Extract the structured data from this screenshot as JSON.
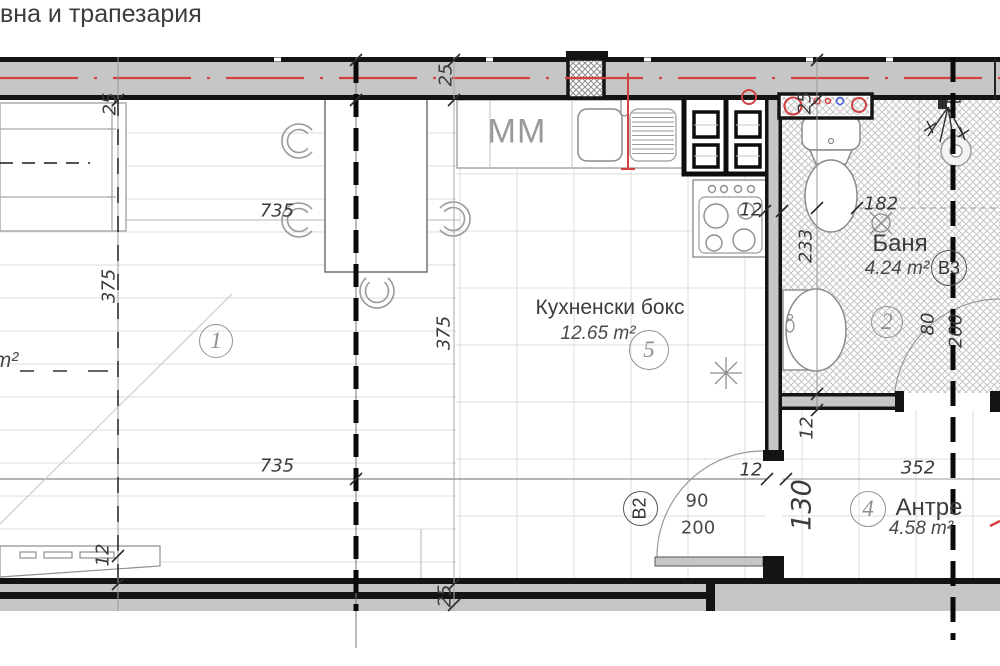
{
  "rooms": {
    "living": {
      "label": "вна и трапезария",
      "area_unit": "m²",
      "number": "1"
    },
    "kitchen": {
      "label": "Кухненски бокс",
      "area": "12.65 m²",
      "number": "5"
    },
    "bathroom": {
      "label": "Баня",
      "area": "4.24 m²",
      "number": "2"
    },
    "hallway": {
      "label": "Антре",
      "area": "4.58 m²",
      "number": "4"
    }
  },
  "markers": {
    "door_b2": "В2",
    "door_b3": "В3",
    "kitchen_unit": "MM"
  },
  "dimension_labels": [
    {
      "text": "25",
      "x": 110,
      "y": 104,
      "rot": -90
    },
    {
      "text": "25",
      "x": 446,
      "y": 75,
      "rot": -90
    },
    {
      "text": "25",
      "x": 805,
      "y": 103,
      "rot": -90
    },
    {
      "text": "25",
      "x": 445,
      "y": 596,
      "rot": -90
    },
    {
      "text": "735",
      "x": 277,
      "y": 211
    },
    {
      "text": "735",
      "x": 277,
      "y": 466
    },
    {
      "text": "375",
      "x": 109,
      "y": 286,
      "rot": -90
    },
    {
      "text": "375",
      "x": 444,
      "y": 333,
      "rot": -90
    },
    {
      "text": "12",
      "x": 103,
      "y": 555,
      "rot": -90
    },
    {
      "text": "12",
      "x": 751,
      "y": 210
    },
    {
      "text": "12",
      "x": 807,
      "y": 428,
      "rot": -90
    },
    {
      "text": "12",
      "x": 751,
      "y": 470
    },
    {
      "text": "233",
      "x": 806,
      "y": 246,
      "rot": -90
    },
    {
      "text": "182",
      "x": 881,
      "y": 204
    },
    {
      "text": "80",
      "x": 928,
      "y": 324,
      "rot": -90
    },
    {
      "text": "200",
      "x": 956,
      "y": 331,
      "rot": -90
    },
    {
      "text": "90",
      "x": 697,
      "y": 501,
      "upright": true
    },
    {
      "text": "200",
      "x": 698,
      "y": 528,
      "upright": true
    },
    {
      "text": "130",
      "x": 802,
      "y": 505,
      "rot": -90,
      "size": 27
    },
    {
      "text": "352",
      "x": 918,
      "y": 468
    }
  ],
  "colors": {
    "wall_fill": "#c6c6c6",
    "wall_edge": "#141414",
    "accent_red": "#d24040",
    "accent_blue": "#3a5bd7"
  }
}
